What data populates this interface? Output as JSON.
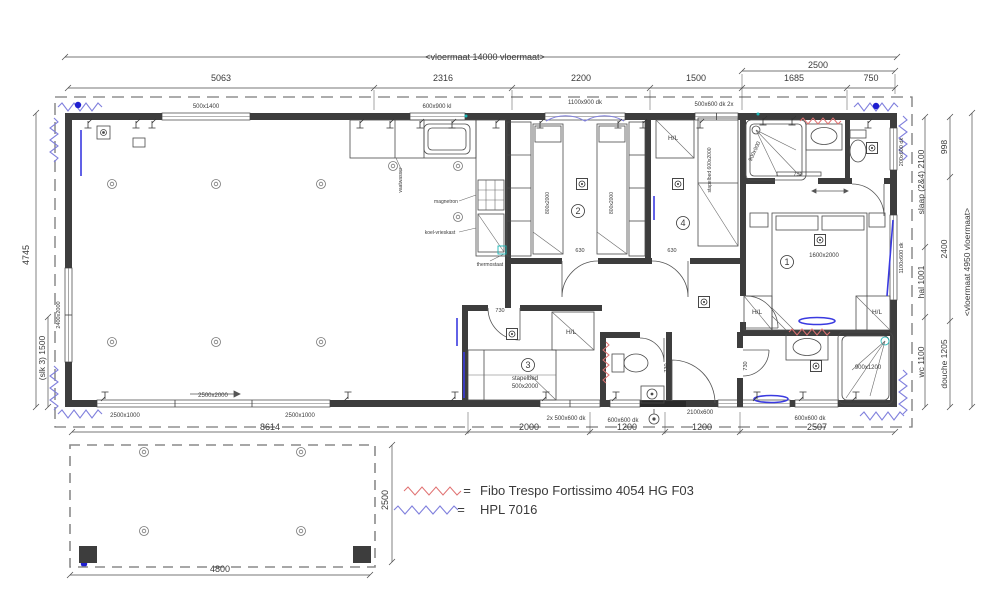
{
  "plan": {
    "labels": [
      {
        "n": "dim-floor-width",
        "t": "<vloermaat 14000 vloermaat>",
        "x": 485,
        "y": 60,
        "s": 9
      },
      {
        "n": "dim-2500-top",
        "t": "2500",
        "x": 818,
        "y": 68,
        "s": 9
      },
      {
        "n": "dim-5063",
        "t": "5063",
        "x": 221,
        "y": 81,
        "s": 9
      },
      {
        "n": "dim-2316",
        "t": "2316",
        "x": 443,
        "y": 81,
        "s": 9
      },
      {
        "n": "dim-2200",
        "t": "2200",
        "x": 581,
        "y": 81,
        "s": 9
      },
      {
        "n": "dim-1500",
        "t": "1500",
        "x": 696,
        "y": 81,
        "s": 9
      },
      {
        "n": "dim-1685",
        "t": "1685",
        "x": 794,
        "y": 81,
        "s": 9
      },
      {
        "n": "dim-750",
        "t": "750",
        "x": 871,
        "y": 81,
        "s": 9
      },
      {
        "n": "win-500x1400",
        "t": "500x1400",
        "x": 206,
        "y": 108,
        "s": 6
      },
      {
        "n": "win-600x900",
        "t": "600x900 kl",
        "x": 437,
        "y": 108,
        "s": 6
      },
      {
        "n": "win-1100x900",
        "t": "1100x900 dk",
        "x": 585,
        "y": 104,
        "s": 6
      },
      {
        "n": "win-500x600-2x",
        "t": "500x600 dk 2x",
        "x": 714,
        "y": 106,
        "s": 6
      },
      {
        "n": "dim-998",
        "t": "998",
        "x": 947,
        "y": 147,
        "s": 8.5,
        "r": -90
      },
      {
        "n": "dim-slaap24-2100",
        "t": "slaap (2&4) 2100",
        "x": 924,
        "y": 182,
        "s": 8.5,
        "r": -90
      },
      {
        "n": "dim-2400",
        "t": "2400",
        "x": 947,
        "y": 249,
        "s": 8.5,
        "r": -90
      },
      {
        "n": "dim-hal-1001",
        "t": "hal 1001",
        "x": 924,
        "y": 282,
        "s": 8.5,
        "r": -90
      },
      {
        "n": "dim-wc-1100",
        "t": "wc 1100",
        "x": 924,
        "y": 362,
        "s": 8.5,
        "r": -90
      },
      {
        "n": "dim-douche-1205",
        "t": "douche 1205",
        "x": 947,
        "y": 364,
        "s": 8.5,
        "r": -90
      },
      {
        "n": "dim-floor-depth",
        "t": "<vloermaat 4950 vloermaat>",
        "x": 970,
        "y": 262,
        "s": 8.5,
        "r": -90
      },
      {
        "n": "win-200x600",
        "t": "200x600 dk",
        "x": 903,
        "y": 152,
        "s": 5.5,
        "r": -90
      },
      {
        "n": "win-1100x600",
        "t": "1100x600 dk",
        "x": 903,
        "y": 258,
        "s": 5.5,
        "r": -90
      },
      {
        "n": "dim-4745",
        "t": "4745",
        "x": 29,
        "y": 255,
        "s": 9,
        "r": -90
      },
      {
        "n": "dim-slk3-1500",
        "t": "(slk 3) 1500",
        "x": 45,
        "y": 358,
        "s": 8.5,
        "r": -90
      },
      {
        "n": "win-2400x2000",
        "t": "2400x2000",
        "x": 60,
        "y": 315,
        "s": 5.5,
        "r": -90
      },
      {
        "n": "dim-8614",
        "t": "8614",
        "x": 270,
        "y": 430,
        "s": 9
      },
      {
        "n": "dim-2000",
        "t": "2000",
        "x": 529,
        "y": 430,
        "s": 9
      },
      {
        "n": "dim-1200-a",
        "t": "1200",
        "x": 627,
        "y": 430,
        "s": 9
      },
      {
        "n": "dim-1200-b",
        "t": "1200",
        "x": 702,
        "y": 430,
        "s": 9
      },
      {
        "n": "dim-2507",
        "t": "2507",
        "x": 817,
        "y": 430,
        "s": 9
      },
      {
        "n": "win-2500x1000-a",
        "t": "2500x1000",
        "x": 125,
        "y": 417,
        "s": 6
      },
      {
        "n": "win-2500x2000",
        "t": "2500x2000",
        "x": 213,
        "y": 397,
        "s": 6
      },
      {
        "n": "win-2500x1000-b",
        "t": "2500x1000",
        "x": 300,
        "y": 417,
        "s": 6
      },
      {
        "n": "win-2x500x600",
        "t": "2x 500x600 dk",
        "x": 566,
        "y": 420,
        "s": 6
      },
      {
        "n": "win-600x600-a",
        "t": "600x600 dk",
        "x": 623,
        "y": 422,
        "s": 6
      },
      {
        "n": "win-2100x600",
        "t": "2100x600",
        "x": 700,
        "y": 414,
        "s": 6
      },
      {
        "n": "win-600x600-b",
        "t": "600x600 dk",
        "x": 810,
        "y": 420,
        "s": 6
      },
      {
        "n": "dim-4800",
        "t": "4800",
        "x": 220,
        "y": 572,
        "s": 9
      },
      {
        "n": "dim-2500-terrace",
        "t": "2500",
        "x": 388,
        "y": 500,
        "s": 9,
        "r": -90
      },
      {
        "n": "legend-eq-1",
        "t": "=",
        "x": 467,
        "y": 495,
        "s": 13,
        "c": "#3c3c3c"
      },
      {
        "n": "legend-fibo",
        "t": "Fibo Trespo Fortissimo  4054 HG F03",
        "x": 480,
        "y": 495,
        "s": 13,
        "a": "start",
        "c": "#3c3c3c"
      },
      {
        "n": "legend-eq-2",
        "t": "=",
        "x": 461,
        "y": 514,
        "s": 13,
        "c": "#3c3c3c"
      },
      {
        "n": "legend-hpl",
        "t": "HPL 7016",
        "x": 480,
        "y": 514,
        "s": 13,
        "a": "start",
        "c": "#3c3c3c"
      },
      {
        "n": "room-2-number",
        "t": "2",
        "x": 578,
        "y": 214,
        "s": 9
      },
      {
        "n": "room-4-number",
        "t": "4",
        "x": 683,
        "y": 226,
        "s": 9
      },
      {
        "n": "room-1-number",
        "t": "1",
        "x": 787,
        "y": 265,
        "s": 9
      },
      {
        "n": "room-3-number",
        "t": "3",
        "x": 528,
        "y": 368,
        "s": 9
      },
      {
        "n": "bed2-left",
        "t": "800x2000",
        "x": 549,
        "y": 203,
        "s": 5,
        "r": -90
      },
      {
        "n": "bed2-right",
        "t": "800x2000",
        "x": 613,
        "y": 203,
        "s": 5,
        "r": -90
      },
      {
        "n": "bed1-size",
        "t": "1600x2000",
        "x": 824,
        "y": 257,
        "s": 6
      },
      {
        "n": "bed4-stapelbed",
        "t": "stapelbed 600x2000",
        "x": 711,
        "y": 170,
        "s": 5,
        "r": -90
      },
      {
        "n": "bed3-stapelbed",
        "t": "stapelbed",
        "x": 525,
        "y": 380,
        "s": 6
      },
      {
        "n": "bed3-size",
        "t": "500x2000",
        "x": 525,
        "y": 388,
        "s": 6
      },
      {
        "n": "shower-top-size",
        "t": "900x900",
        "x": 756,
        "y": 152,
        "s": 5.5,
        "r": -65,
        "c": "#5566bb"
      },
      {
        "n": "shower-bottom-size",
        "t": "900x1200",
        "x": 868,
        "y": 369,
        "s": 6
      },
      {
        "n": "hl-room4",
        "t": "H/L",
        "x": 673,
        "y": 140,
        "s": 6.5
      },
      {
        "n": "hl-room3",
        "t": "H/L",
        "x": 571,
        "y": 334,
        "s": 6.5
      },
      {
        "n": "hl-room1-left",
        "t": "H/L",
        "x": 757,
        "y": 314,
        "s": 6.5
      },
      {
        "n": "hl-room1-right",
        "t": "H/L",
        "x": 877,
        "y": 314,
        "s": 6.5
      },
      {
        "n": "lbl-vaatwasser",
        "t": "vaatwasser",
        "x": 402,
        "y": 180,
        "s": 5,
        "r": -90
      },
      {
        "n": "lbl-magnetron",
        "t": "magnetron",
        "x": 446,
        "y": 203,
        "s": 5
      },
      {
        "n": "lbl-koelvrieskast",
        "t": "koel-vrieskast",
        "x": 440,
        "y": 234,
        "s": 5
      },
      {
        "n": "lbl-thermostaat",
        "t": "thermostaat",
        "x": 490,
        "y": 266,
        "s": 5
      },
      {
        "n": "door-730-bath",
        "t": "730",
        "x": 798,
        "y": 176,
        "s": 5.5
      },
      {
        "n": "door-730-room3",
        "t": "730",
        "x": 500,
        "y": 312,
        "s": 5.5
      },
      {
        "n": "door-730-wc",
        "t": "730",
        "x": 668,
        "y": 368,
        "s": 5.5,
        "r": -90
      },
      {
        "n": "door-730-douche",
        "t": "730",
        "x": 747,
        "y": 366,
        "s": 5.5,
        "r": -90
      },
      {
        "n": "door-630-room2",
        "t": "630",
        "x": 580,
        "y": 252,
        "s": 5.5
      },
      {
        "n": "door-630-room4",
        "t": "630",
        "x": 672,
        "y": 252,
        "s": 5.5
      }
    ]
  },
  "legend": {
    "items": [
      {
        "swatch": "red-zigzag",
        "eq": "=",
        "label": "Fibo Trespo Fortissimo  4054 HG F03"
      },
      {
        "swatch": "blue-zigzag",
        "eq": "=",
        "label": "HPL 7016"
      }
    ]
  },
  "colors": {
    "wall": "#3d3d3d",
    "fibo_red": "#e07070",
    "hpl_blue": "#8080dd",
    "marker_blue": "#1f1fd0",
    "door_blue": "#3a3ae0"
  }
}
